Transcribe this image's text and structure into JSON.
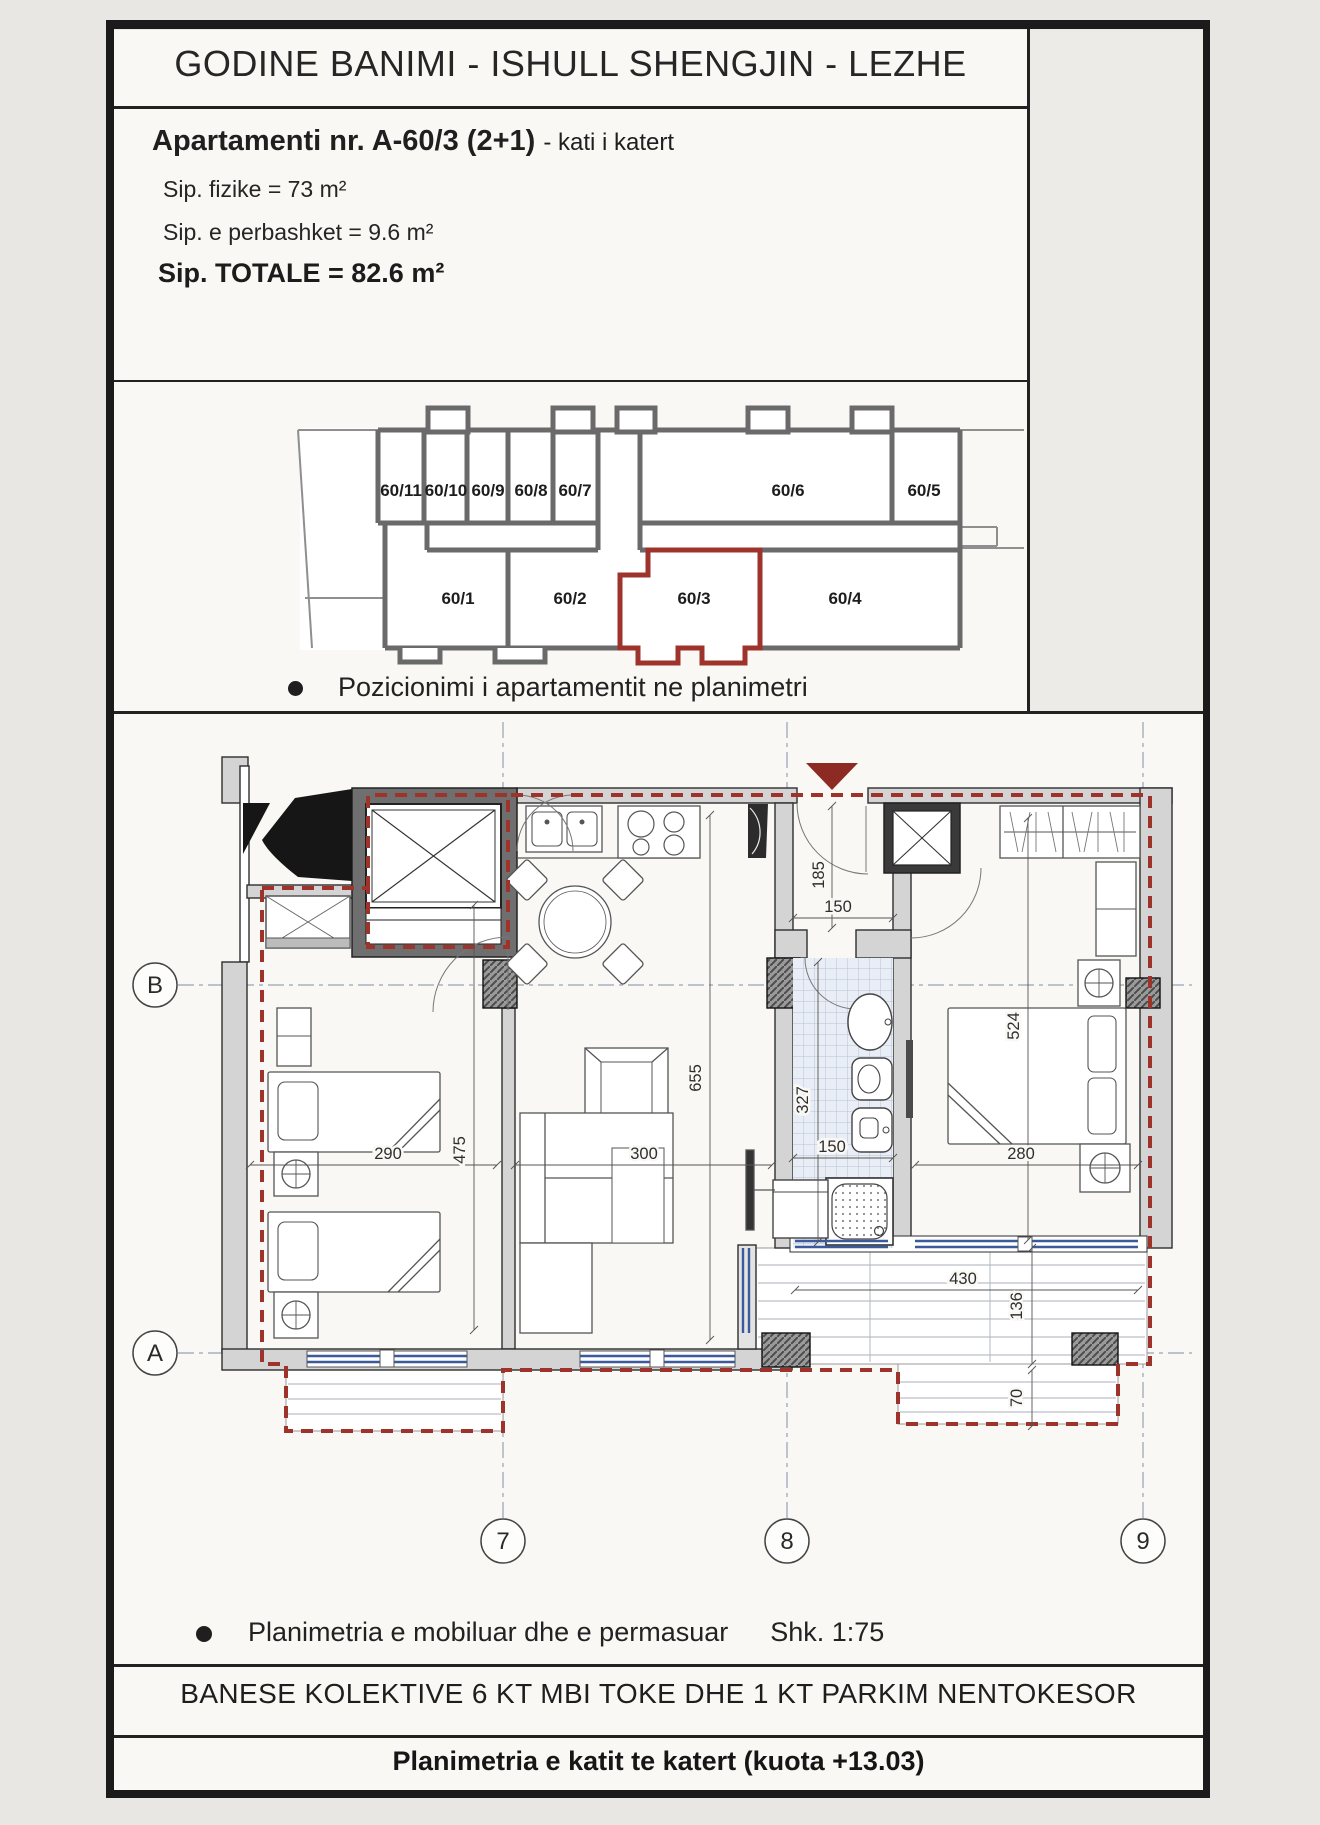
{
  "header": {
    "title": "GODINE BANIMI - ISHULL SHENGJIN - LEZHE"
  },
  "apartment": {
    "name": "Apartamenti nr. A-60/3 (2+1)",
    "floor_note": "- kati i katert",
    "area_physical": "Sip. fizike = 73 m²",
    "area_common": "Sip. e perbashket = 9.6 m²",
    "area_total": "Sip. TOTALE = 82.6 m²"
  },
  "position_map": {
    "caption": "Pozicionimi i apartamentit ne planimetri",
    "highlighted_unit": "60/3",
    "units_top_row": [
      "60/11",
      "60/10",
      "60/9",
      "60/8",
      "60/7",
      "60/6",
      "60/5"
    ],
    "units_bottom_row": [
      "60/1",
      "60/2",
      "60/3",
      "60/4"
    ]
  },
  "floor_plan": {
    "caption": "Planimetria e mobiluar dhe e permasuar",
    "scale": "Shk. 1:75",
    "grid_axes": {
      "horizontal": [
        "B",
        "A"
      ],
      "vertical": [
        "7",
        "8",
        "9"
      ]
    },
    "dimensions": {
      "entry_depth": "185",
      "entry_width": "150",
      "living_length": "655",
      "living_width": "300",
      "bath_length": "327",
      "bath_width": "150",
      "bedroom1_width": "290",
      "bedroom1_length": "475",
      "bedroom2_width": "280",
      "bedroom2_length": "524",
      "terrace_width": "430",
      "terrace_depth": "136",
      "balcony_depth": "70"
    },
    "colors": {
      "boundary_red": "#9e332c",
      "window_blue": "#3a5a9b"
    }
  },
  "footer": {
    "building_line": "BANESE KOLEKTIVE 6 KT MBI TOKE  DHE 1 KT PARKIM NENTOKESOR",
    "sheet_line": "Planimetria e katit te katert (kuota +13.03)"
  }
}
